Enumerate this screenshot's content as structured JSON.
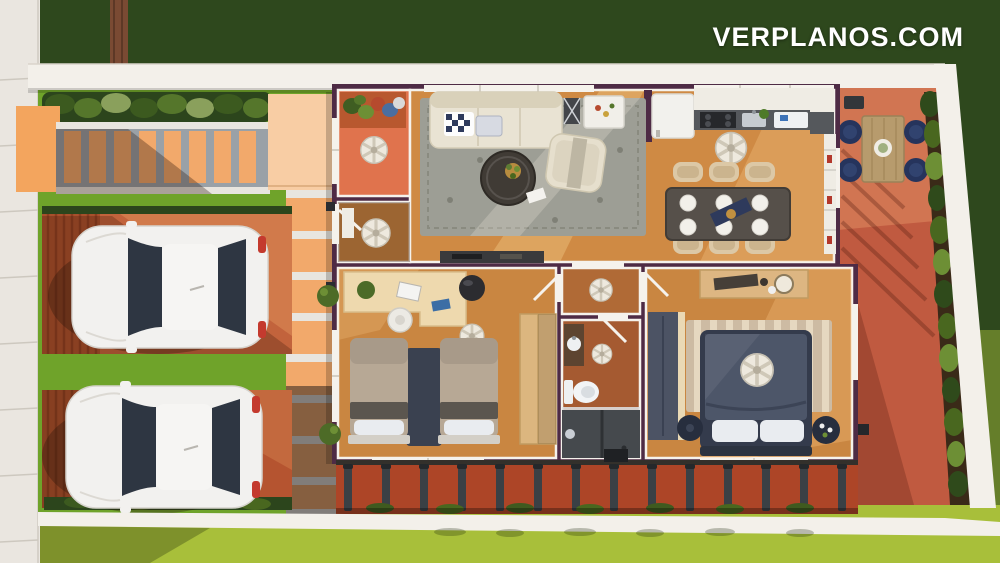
{
  "watermark": {
    "text": "VERPLANOS.COM"
  },
  "palette": {
    "grassDark": "#2e481d",
    "grassBright": "#a8bf3a",
    "lawnGreen": "#6fa32a",
    "sidewalk": "#eae6e0",
    "wallWhite": "#f3f0ea",
    "hedgeDark": "#2c451c",
    "paver": "#f2a96b",
    "paverGap": "#9aa1a7",
    "porchSlab": "#f8cda4",
    "driveway": "#c2633c",
    "houseWall": "#4e2b45",
    "trimWhite": "#f5f2ec",
    "woodFloor": "#cf8a44",
    "porchFloor": "#e0734d",
    "patio": "#c05a40",
    "fenceRed": "#ad4527",
    "fencePost": "#3a4045",
    "sofaCream": "#e9e3d3",
    "rugGray": "#9d9e95",
    "tableDark": "#56504a",
    "chairTan": "#dcc8a6",
    "navyBlue": "#2e3a5c",
    "bedNavy": "#4d5669",
    "bedTan": "#b7a895",
    "pillowWhite": "#e9ecf0",
    "rugNavy": "#3a4150",
    "carWhite": "#f2f1ef",
    "carGlass": "#2e3642",
    "taillight": "#c43a2e"
  }
}
